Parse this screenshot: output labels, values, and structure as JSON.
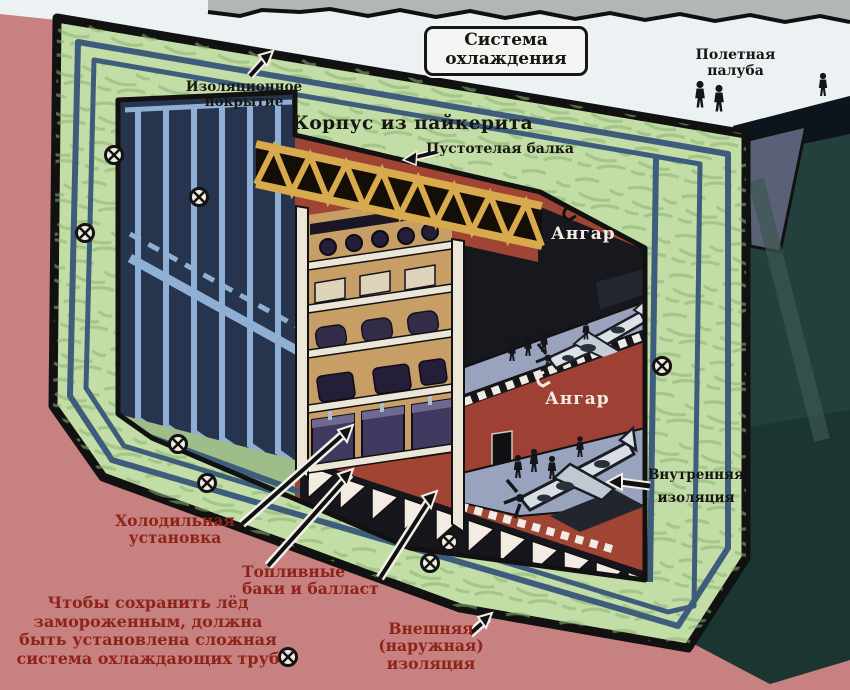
{
  "labels": {
    "cooling_system": [
      "Система",
      "охлаждения"
    ],
    "flight_deck": [
      "Полетная",
      "палуба"
    ],
    "insulation_coating": [
      "Изоляционное",
      "покрытие"
    ],
    "pykrete_hull": "Корпус из пайкерита",
    "hollow_beam": "Пустотелая балка",
    "hangar_upper": "Ангар",
    "hangar_lower": "Ангар",
    "internal_insulation": [
      "Внутренняя",
      "изоляция"
    ],
    "refrigeration_unit": [
      "Холодильная",
      "установка"
    ],
    "fuel_tanks": [
      "Топливные",
      "баки и балласт"
    ],
    "external_insulation": [
      "Внешняя",
      "(наружная)",
      "изоляция"
    ],
    "cooling_note": [
      "Чтобы сохранить лёд",
      "замороженным, должна",
      "быть установлена сложная",
      "система охлаждающих труб"
    ]
  },
  "colors": {
    "background_pink": "#c78181",
    "pykrete_green": "#c3dda6",
    "hull_interior_red": "#a04434",
    "pipe_blue": "#8fb0d4",
    "pipe_dark_blue": "#3e5c7c",
    "navy_wall": "#26344e",
    "label_maroon": "#8e2418",
    "deck_white": "#edf2f5",
    "side_teal": "#24403c",
    "truss_yellow": "#d9a94e",
    "hangar_floor": "#99a3bd"
  }
}
